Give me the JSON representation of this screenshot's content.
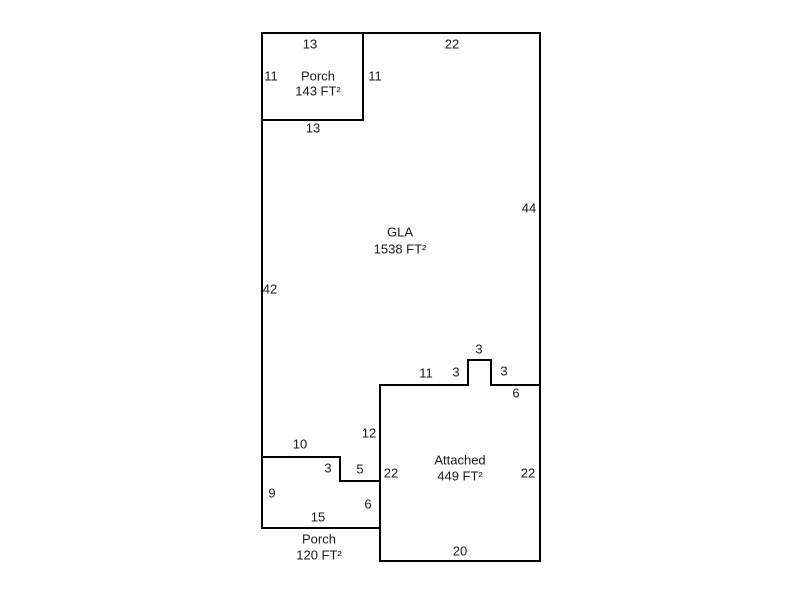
{
  "page": {
    "background_color": "#ffffff"
  },
  "sketch": {
    "type": "floor-plan",
    "line_color": "#000000",
    "text_color": "#1a1a1a",
    "regions": [
      {
        "name": "porch-top",
        "title": "Porch",
        "area": "143 FT²",
        "x": 318,
        "title_y": 76,
        "area_y": 91
      },
      {
        "name": "gla",
        "title": "GLA",
        "area": "1538 FT²",
        "x": 400,
        "title_y": 232,
        "area_y": 249
      },
      {
        "name": "attached-garage",
        "title": "Attached",
        "area": "449 FT²",
        "x": 460,
        "title_y": 460,
        "area_y": 476
      },
      {
        "name": "porch-bottom",
        "title": "Porch",
        "area": "120 FT²",
        "x": 319,
        "title_y": 539,
        "area_y": 555
      }
    ],
    "dimension_labels": [
      {
        "text": "13",
        "x": 310,
        "y": 44,
        "edge": "porch-top-top-width"
      },
      {
        "text": "22",
        "x": 452,
        "y": 44,
        "edge": "gla-top-width"
      },
      {
        "text": "11",
        "x": 271,
        "y": 76,
        "edge": "porch-top-left-height"
      },
      {
        "text": "11",
        "x": 375,
        "y": 76,
        "edge": "porch-top-right-height"
      },
      {
        "text": "13",
        "x": 313,
        "y": 128,
        "edge": "porch-top-bottom-width"
      },
      {
        "text": "44",
        "x": 529,
        "y": 208,
        "edge": "gla-right-height"
      },
      {
        "text": "42",
        "x": 270,
        "y": 289,
        "edge": "gla-left-height"
      },
      {
        "text": "3",
        "x": 479,
        "y": 349,
        "edge": "bump-top-width"
      },
      {
        "text": "11",
        "x": 426,
        "y": 373,
        "edge": "garage-top-left-width"
      },
      {
        "text": "3",
        "x": 456,
        "y": 372,
        "edge": "bump-left-height"
      },
      {
        "text": "3",
        "x": 504,
        "y": 371,
        "edge": "bump-right-height"
      },
      {
        "text": "6",
        "x": 516,
        "y": 393,
        "edge": "garage-top-right-width"
      },
      {
        "text": "12",
        "x": 369,
        "y": 433,
        "edge": "gla-step-right-height"
      },
      {
        "text": "10",
        "x": 300,
        "y": 444,
        "edge": "porch-bottom-top-width"
      },
      {
        "text": "3",
        "x": 328,
        "y": 468,
        "edge": "step-height"
      },
      {
        "text": "5",
        "x": 360,
        "y": 469,
        "edge": "step-width"
      },
      {
        "text": "22",
        "x": 391,
        "y": 473,
        "edge": "garage-left-height"
      },
      {
        "text": "22",
        "x": 528,
        "y": 473,
        "edge": "garage-right-height"
      },
      {
        "text": "9",
        "x": 272,
        "y": 493,
        "edge": "porch-bottom-left-height"
      },
      {
        "text": "6",
        "x": 368,
        "y": 504,
        "edge": "porch-bottom-right-height"
      },
      {
        "text": "15",
        "x": 318,
        "y": 517,
        "edge": "porch-bottom-bottom-width"
      },
      {
        "text": "20",
        "x": 460,
        "y": 551,
        "edge": "garage-bottom-width"
      }
    ],
    "walls": [
      {
        "id": "top-edge",
        "x1": 262,
        "y1": 33,
        "x2": 540,
        "y2": 33
      },
      {
        "id": "porch-top-bottom-edge",
        "x1": 262,
        "y1": 120,
        "x2": 363,
        "y2": 120
      },
      {
        "id": "bump-top-edge",
        "x1": 468,
        "y1": 360,
        "x2": 491,
        "y2": 360
      },
      {
        "id": "garage-top-left-edge",
        "x1": 380,
        "y1": 385,
        "x2": 468,
        "y2": 385
      },
      {
        "id": "garage-top-right-edge",
        "x1": 491,
        "y1": 385,
        "x2": 540,
        "y2": 385
      },
      {
        "id": "gla-bottom-left-edge",
        "x1": 262,
        "y1": 457,
        "x2": 340,
        "y2": 457
      },
      {
        "id": "step-bottom-edge",
        "x1": 340,
        "y1": 481,
        "x2": 380,
        "y2": 481
      },
      {
        "id": "porch-bottom-bottom-edge",
        "x1": 262,
        "y1": 528,
        "x2": 380,
        "y2": 528
      },
      {
        "id": "garage-bottom-edge",
        "x1": 380,
        "y1": 561,
        "x2": 540,
        "y2": 561
      },
      {
        "id": "left-edge",
        "x1": 262,
        "y1": 33,
        "x2": 262,
        "y2": 528
      },
      {
        "id": "porch-top-right-edge",
        "x1": 363,
        "y1": 33,
        "x2": 363,
        "y2": 120
      },
      {
        "id": "right-edge",
        "x1": 540,
        "y1": 33,
        "x2": 540,
        "y2": 561
      },
      {
        "id": "bump-left-edge",
        "x1": 468,
        "y1": 360,
        "x2": 468,
        "y2": 385
      },
      {
        "id": "bump-right-edge",
        "x1": 491,
        "y1": 360,
        "x2": 491,
        "y2": 385
      },
      {
        "id": "garage-left-edge",
        "x1": 380,
        "y1": 385,
        "x2": 380,
        "y2": 561
      },
      {
        "id": "step-right-edge",
        "x1": 340,
        "y1": 457,
        "x2": 340,
        "y2": 481
      }
    ]
  }
}
